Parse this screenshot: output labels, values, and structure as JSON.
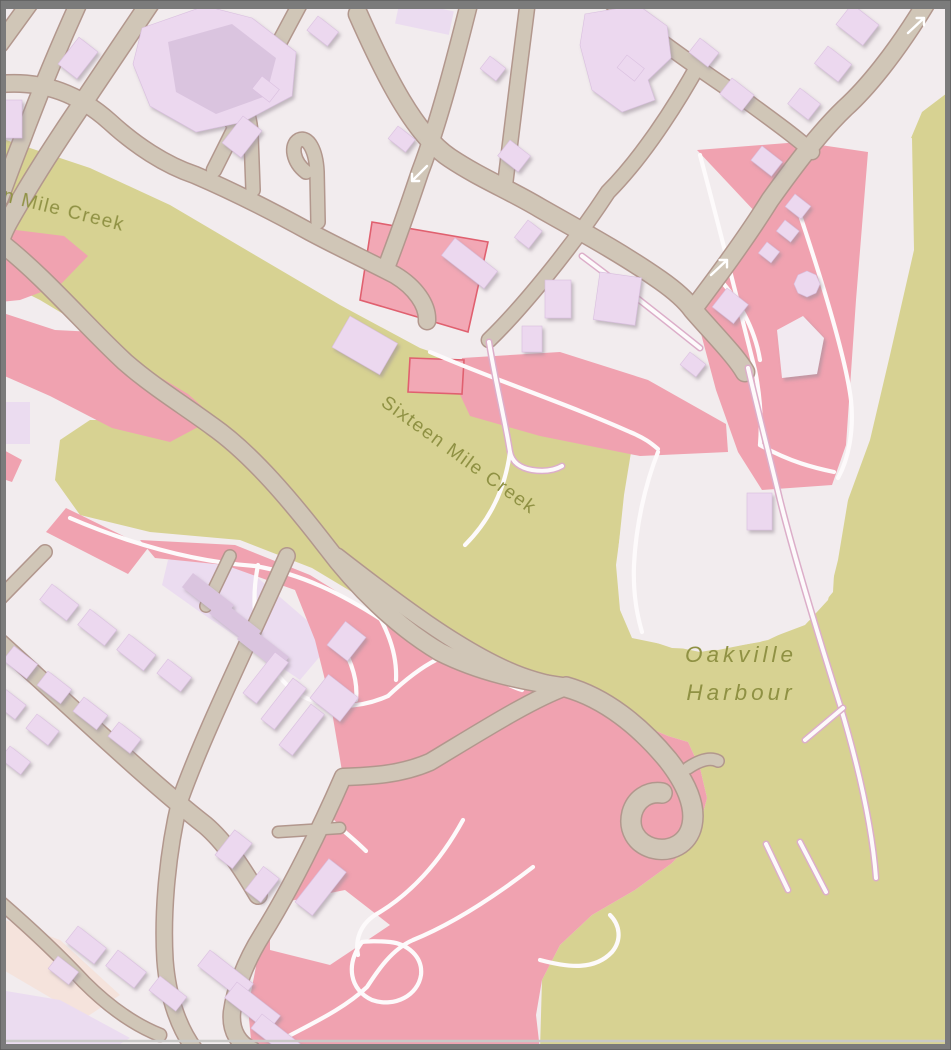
{
  "map": {
    "type": "rendered-map-tile-view",
    "water_labels": {
      "creek_upper": "Sixteen Mile Creek",
      "creek_main": "Sixteen Mile Creek",
      "harbour_line1": "Oakville",
      "harbour_line2": "Harbour"
    },
    "icons": {
      "oneway_arrow_count": 3,
      "oneway_arrow_meaning": "one-way street direction"
    },
    "colors": {
      "frame": "#7b7b7b",
      "frameInner": "#c9c9c7",
      "background": "#f2ecee",
      "water": "#d7d292",
      "park": "#f0a2b0",
      "parkingFill": "#f2a8b5",
      "parkingStroke": "#e0606f",
      "landuse": "#ebdcf0",
      "peach": "#f5e3dc",
      "building": "#ecd8ef",
      "buildingDark": "#dac4df",
      "buildingLight": "#f2eaf1",
      "buildingStroke": "#d9bfdf",
      "roadFill": "#d0c6b7",
      "roadCasing": "#b2978d",
      "serviceCasing": "#d9aac3",
      "path": "#fdfafb",
      "pierCasing": "#dcaec9",
      "label": "#8f9143",
      "arrow": "#ffffff"
    }
  }
}
